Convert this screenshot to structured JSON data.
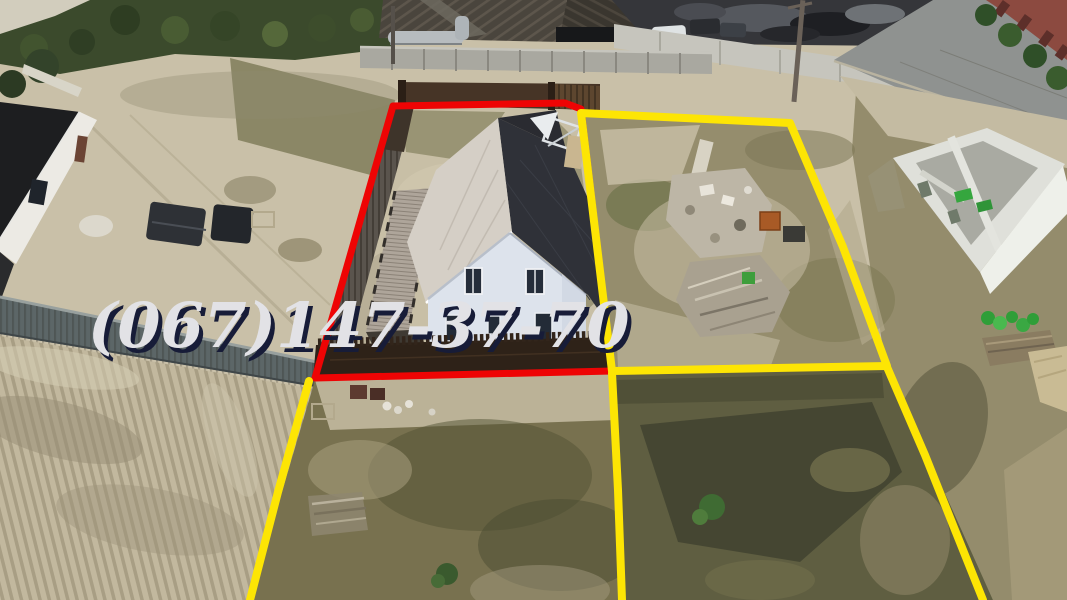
{
  "watermark": {
    "phone_number": "(067)147-37-70"
  },
  "colors": {
    "featured_plot_outline": "#ee0404",
    "adjacent_plot_outline": "#fde504",
    "watermark_text": "#e2e2e6",
    "watermark_shadow": "#171c38"
  }
}
